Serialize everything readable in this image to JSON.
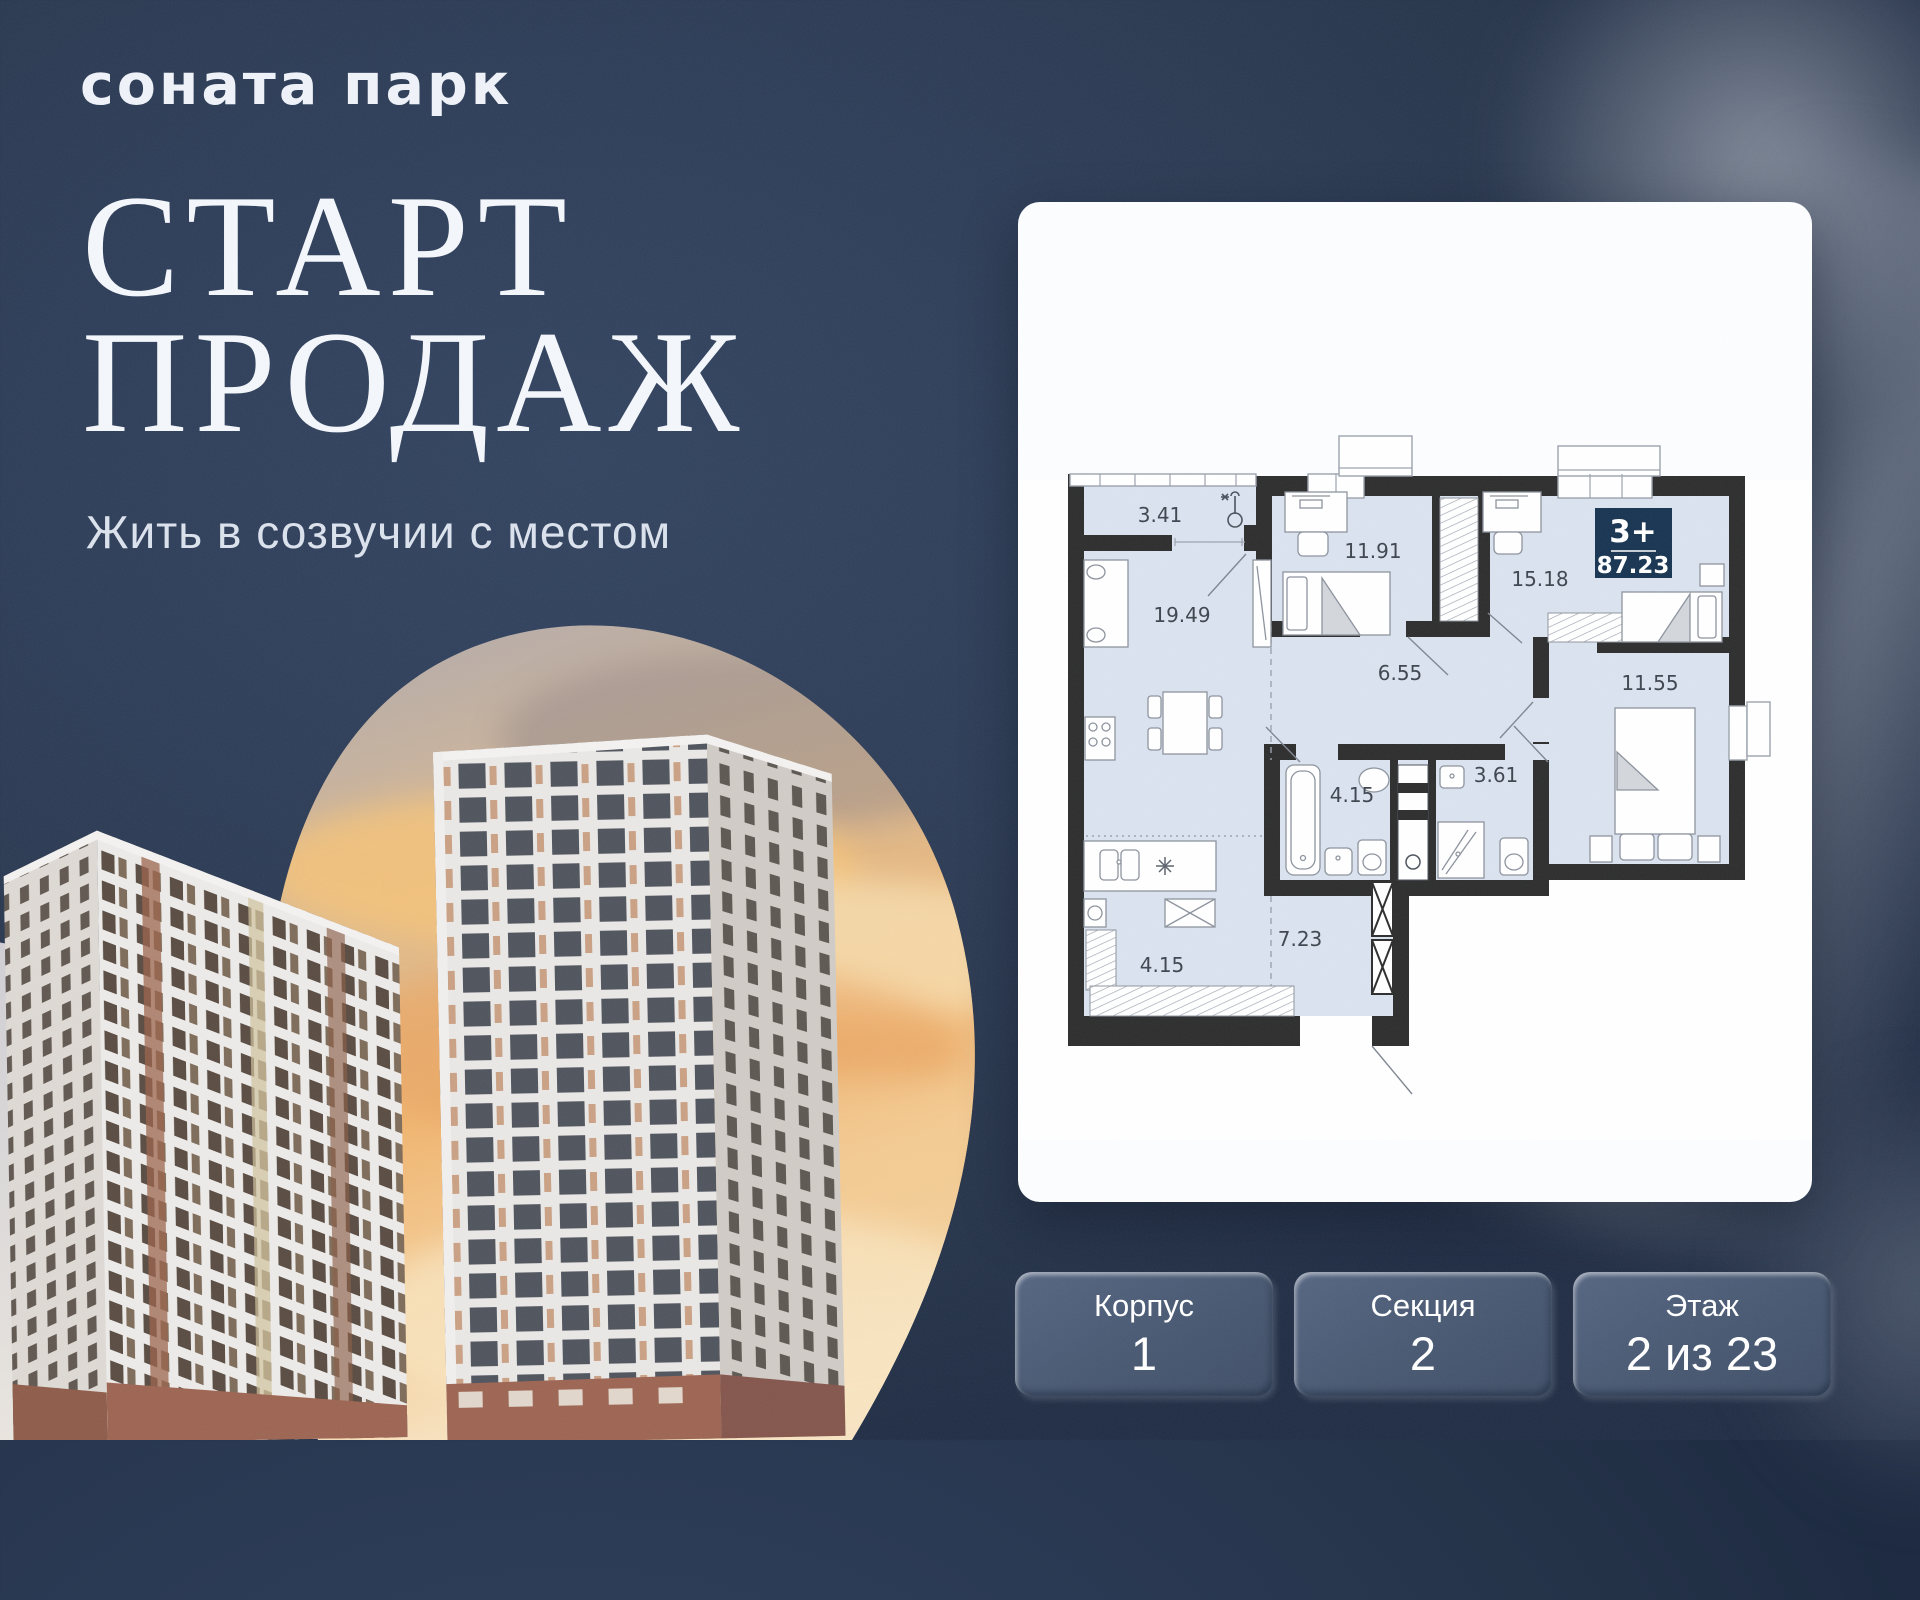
{
  "brand": {
    "name": "соната парк"
  },
  "hero": {
    "line1": "СТАРТ",
    "line2": "ПРОДАЖ",
    "tagline": "Жить в созвучии с местом"
  },
  "apartment": {
    "badge": {
      "rooms": "3+",
      "area": "87.23"
    },
    "room_areas": {
      "balcony": "3.41",
      "bedroom1": "11.91",
      "bedroom2": "15.18",
      "living": "19.49",
      "hall": "6.55",
      "bedroom3": "11.55",
      "bathroom": "4.15",
      "wc": "3.61",
      "corridor": "7.23",
      "wardrobe": "4.15"
    }
  },
  "selectors": [
    {
      "label": "Корпус",
      "value": "1"
    },
    {
      "label": "Секция",
      "value": "2"
    },
    {
      "label": "Этаж",
      "value": "2 из 23"
    }
  ],
  "icons": {
    "balcony": "thermometer-icon",
    "fridge": "snowflake-icon"
  },
  "colors": {
    "background": "#2b3a54",
    "card": "#fcfdfe",
    "badge_navy": "#16324f",
    "room_fill": "#d9e2ee",
    "wall": "#2b2b2b",
    "button": "#46566f",
    "text_light": "#f3f6fa"
  }
}
